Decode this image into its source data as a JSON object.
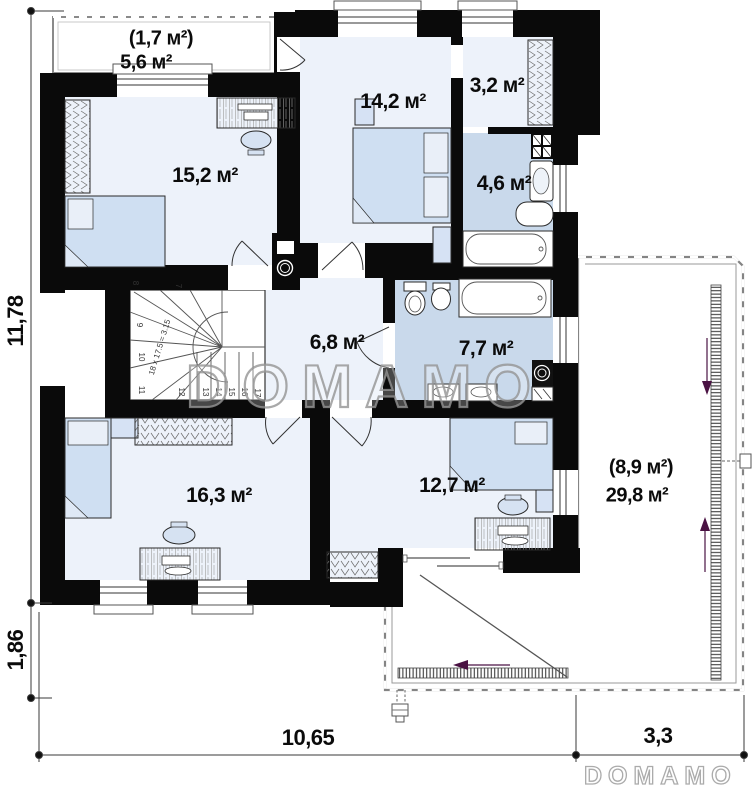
{
  "watermark": {
    "center": "DOMAMO",
    "logo": "DOMAMO"
  },
  "rooms": {
    "balcony_area_small": "(1,7 м²)",
    "balcony_area": "5,6 м²",
    "bedroom_top_left": "15,2 м²",
    "bedroom_top_middle": "14,2 м²",
    "wardrobe": "3,2 м²",
    "bathroom_small": "4,6 м²",
    "hall": "6,8 м²",
    "bathroom_large": "7,7 м²",
    "bedroom_bottom_left": "16,3 м²",
    "bedroom_bottom_middle": "12,7 м²",
    "terrace_area_small": "(8,9 м²)",
    "terrace_area": "29,8 м²"
  },
  "dimensions": {
    "height_total": "11,78",
    "height_lower": "1,86",
    "width_main": "10,65",
    "width_terrace": "3,3"
  },
  "stairs": {
    "formula": "18 x 17.5 = 3.15",
    "steps": [
      "7",
      "8",
      "9",
      "10",
      "11",
      "12",
      "13",
      "14",
      "15",
      "16",
      "17"
    ]
  },
  "colors": {
    "wall": "#0a0a0a",
    "room_floor": "#edf2fa",
    "wet_floor": "#c9d9eb",
    "furniture": "#cfdff2",
    "slope_arrow": "#4a1243",
    "watermark": "#949494"
  }
}
